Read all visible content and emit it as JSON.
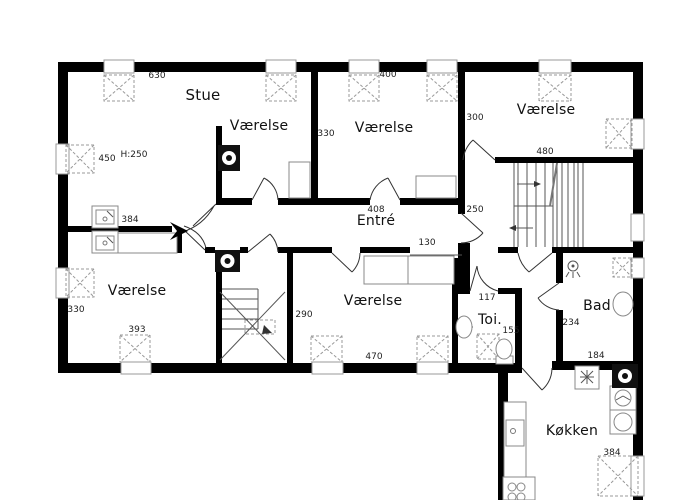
{
  "floorplan": {
    "rooms": {
      "stue": "Stue",
      "vaerelse_nw": "Værelse",
      "vaerelse_n": "Værelse",
      "vaerelse_ne": "Værelse",
      "vaerelse_sw": "Værelse",
      "vaerelse_s": "Værelse",
      "entre": "Entré",
      "toilet": "Toi.",
      "bad": "Bad",
      "koekken": "Køkken"
    },
    "dimensions": {
      "stue_top": "630",
      "stue_left": "450",
      "stue_height": "H:250",
      "v_n_top": "400",
      "v_n_left": "330",
      "v_ne_left": "300",
      "stairhall_top": "480",
      "entre_width": "408",
      "stairhall_left": "250",
      "entre_opening": "130",
      "vestibule": "384",
      "v_sw_left": "330",
      "v_sw_bottom": "393",
      "v_s_left": "290",
      "v_s_bottom": "470",
      "toilet_top": "117",
      "toilet_bottom": "155",
      "bad_left": "234",
      "bad_bottom": "184",
      "koekken_right": "384"
    },
    "colors": {
      "wall": "#000000",
      "thin_line": "#333333",
      "furniture_line": "#888888",
      "marker_dash": "#999999"
    }
  }
}
